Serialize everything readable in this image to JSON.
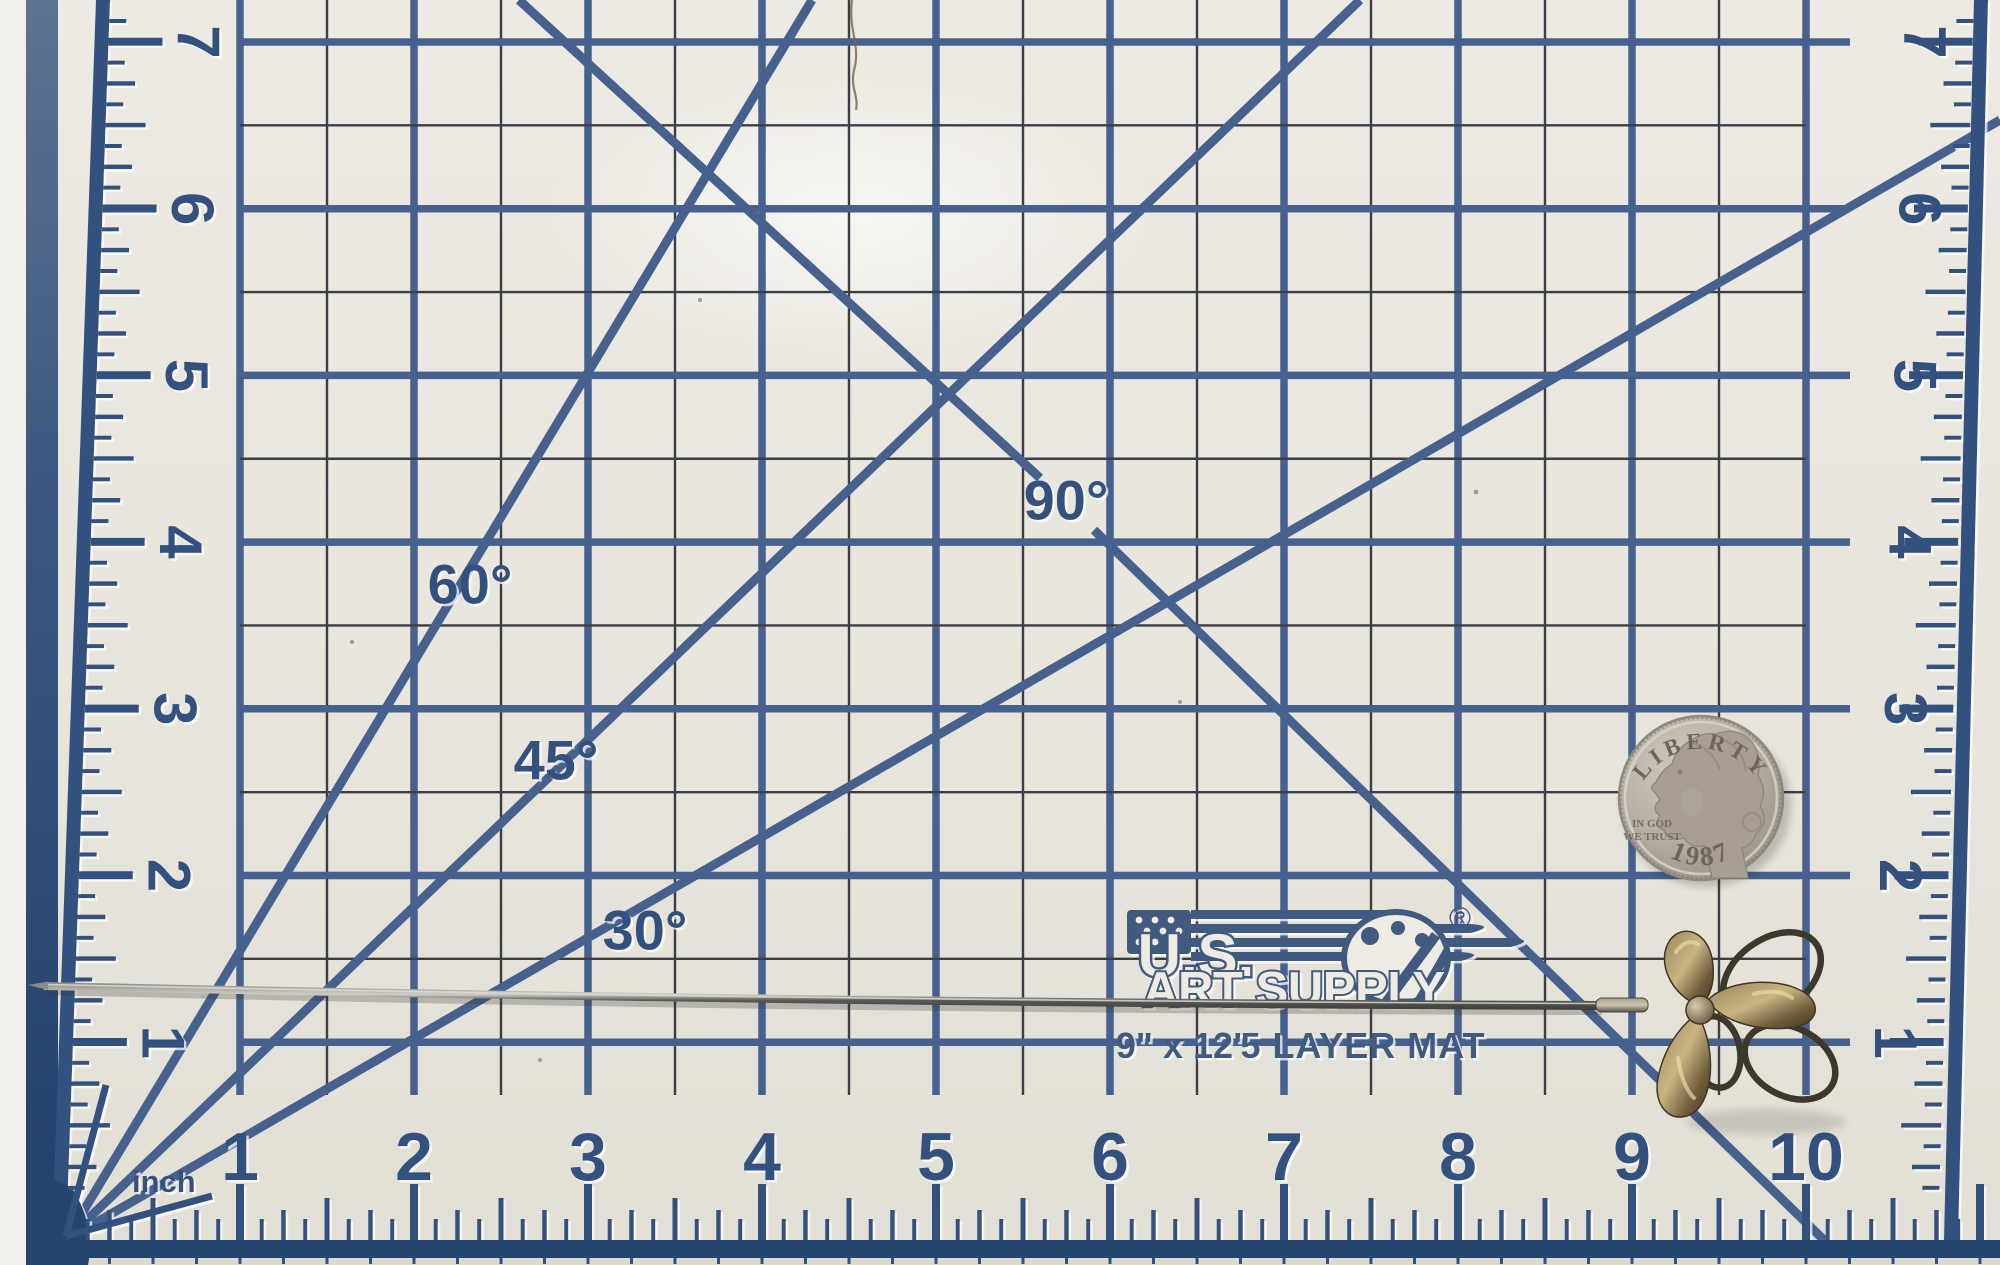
{
  "mat": {
    "unit_label": "inch",
    "bottom_scale": [
      "1",
      "2",
      "3",
      "4",
      "5",
      "6",
      "7",
      "8",
      "9",
      "10"
    ],
    "left_scale": [
      "7",
      "6",
      "5",
      "4",
      "3",
      "2",
      "1"
    ],
    "right_scale": [
      "7",
      "6",
      "5",
      "4",
      "3",
      "2",
      "1"
    ],
    "angle_labels": [
      {
        "text": "90°",
        "x": 1066,
        "y": 500
      },
      {
        "text": "60°",
        "x": 470,
        "y": 584
      },
      {
        "text": "45°",
        "x": 556,
        "y": 760
      },
      {
        "text": "30°",
        "x": 645,
        "y": 930
      }
    ],
    "logo": {
      "brand_top": "U.S.",
      "brand_bottom": "ART SUPPLY",
      "registered": "®",
      "size_text": "9\" x 12\"",
      "layer_text": "5 LAYER MAT"
    }
  },
  "coin": {
    "legend": "LIBERTY",
    "motto_line1": "IN GOD",
    "motto_line2": "WE TRUST",
    "date": "1987"
  },
  "colors": {
    "background": "#f2f0ea",
    "mat_cream": "#e9e6de",
    "grid_blue": "#46618e",
    "minor_line": "#3d3d45",
    "ruler_navy": "#33517f",
    "edge_navy": "#27456d",
    "logo_navy": "#3f5a80",
    "coin_silver": "#b6b0a6",
    "pin_bronze": "#7c6847"
  }
}
